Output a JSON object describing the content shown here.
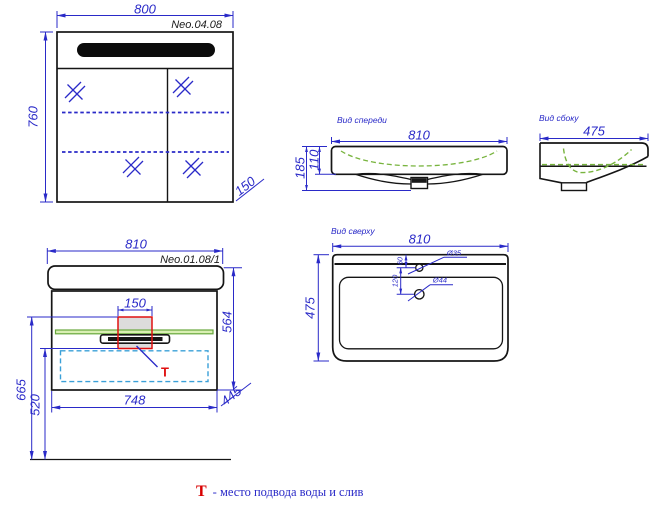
{
  "colors": {
    "dimension_blue": "#2a2ac8",
    "outline_black": "#151515",
    "shelf_green_fill": "#d9efb3",
    "shelf_green_stroke": "#68a73c",
    "basin_dash_green": "#78b43e",
    "drawer_dash_cyan": "#3aa0d8",
    "marker_red": "#e01010",
    "tzone_gray": "#dcdcdc"
  },
  "mirror_cabinet": {
    "model": "Neo.04.08",
    "width": "800",
    "height": "760",
    "depth": "150"
  },
  "washbasin_front": {
    "title": "Вид спереди",
    "width": "810",
    "height_total": "185",
    "height_body": "110"
  },
  "washbasin_side": {
    "title": "Вид сбоку",
    "depth": "475"
  },
  "vanity": {
    "model": "Neo.01.08/1",
    "width": "810",
    "connection_width": "150",
    "height": "564",
    "supply_height": "665",
    "drain_height": "520",
    "inner_width": "748",
    "depth": "445",
    "marker": "Т"
  },
  "washbasin_top": {
    "title": "Вид сверху",
    "width": "810",
    "depth": "475",
    "faucet_hole_dia": "Ø35",
    "drain_hole_dia": "Ø44",
    "hole_spacing": "120",
    "faucet_offset": "60"
  },
  "legend": {
    "marker": "Т",
    "text": "- место подвода воды и слив"
  }
}
